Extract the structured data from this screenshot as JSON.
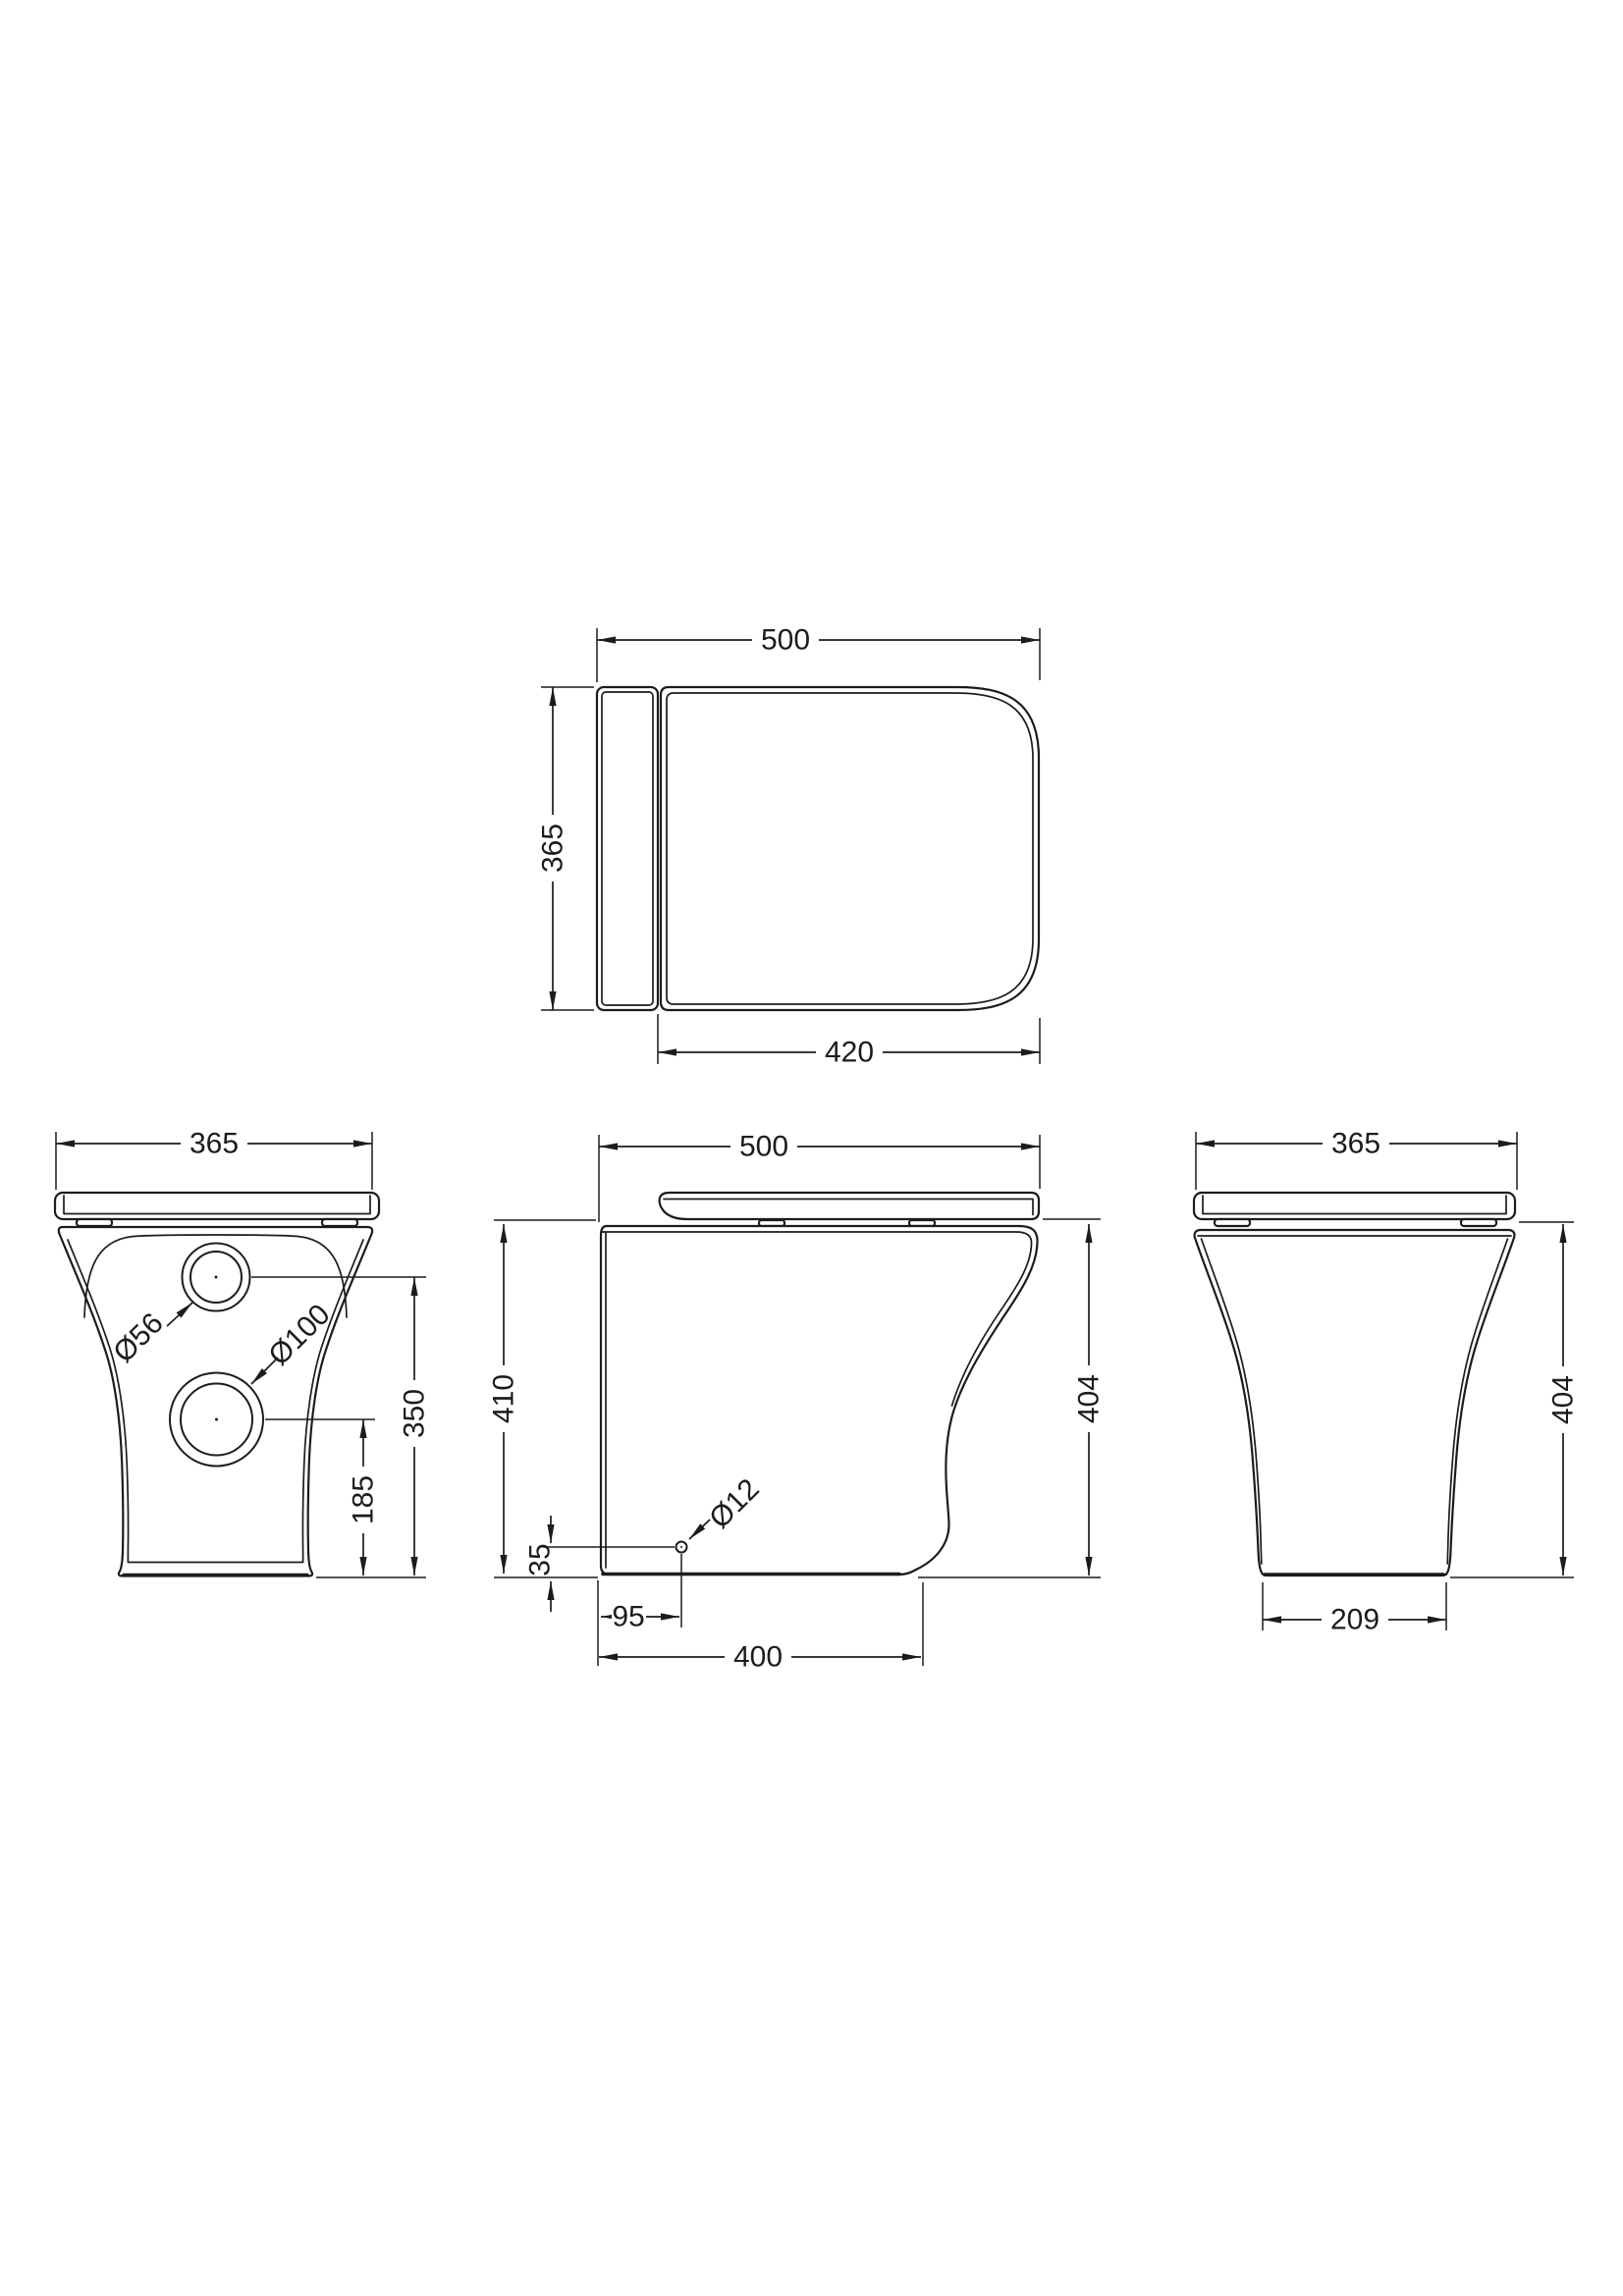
{
  "drawing": {
    "description": "technical-dimension-drawing-back-to-wall-toilet-pan",
    "colors": {
      "line": "#1c1c1c",
      "background": "#ffffff"
    },
    "views": {
      "top": {
        "name": "plan-view-seat-lid",
        "depth": "500",
        "width": "365",
        "lid_length": "420"
      },
      "rear": {
        "name": "rear-view",
        "width": "365",
        "inlet_center_height": "350",
        "outlet_center_height": "185",
        "inlet_diameter": "Ø56",
        "outlet_diameter": "Ø100"
      },
      "side": {
        "name": "side-view",
        "depth": "500",
        "total_height": "410",
        "pan_height": "404",
        "fixing_hole_height": "35",
        "fixing_hole_setback": "95",
        "base_depth": "400",
        "fixing_hole_diameter": "Ø12"
      },
      "front": {
        "name": "front-view",
        "width": "365",
        "pan_height": "404",
        "base_width": "209"
      }
    }
  }
}
